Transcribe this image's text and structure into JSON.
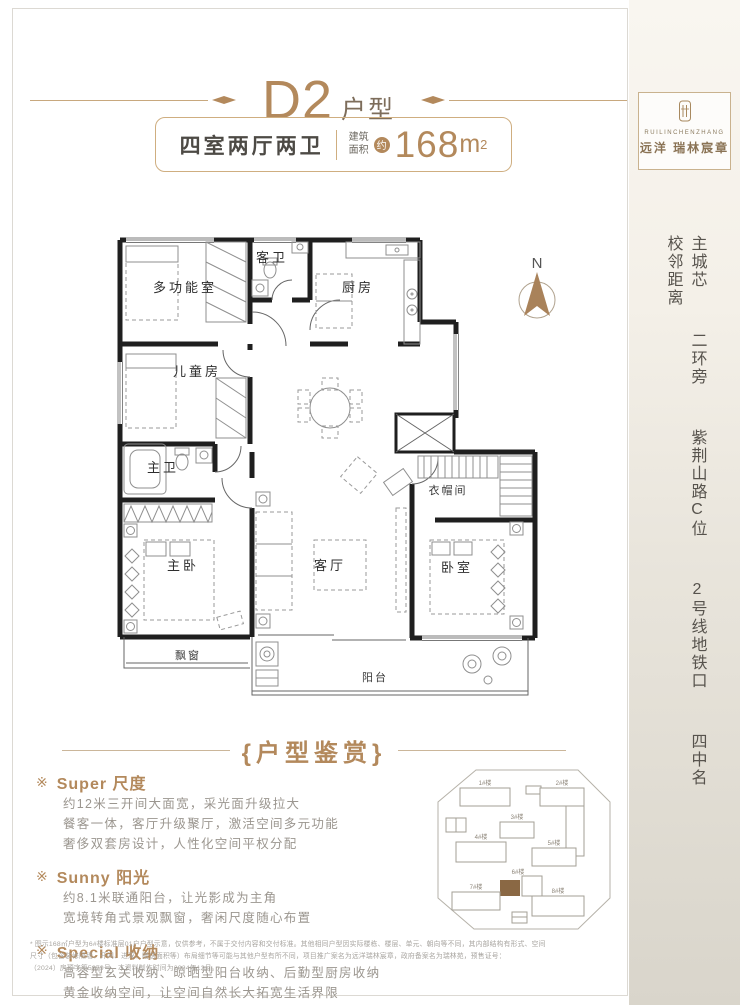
{
  "header": {
    "unit": "D2",
    "unit_suffix": "户型",
    "layout": "四室两厅两卫",
    "area_label_top": "建筑",
    "area_label_bottom": "面积",
    "area_approx": "约",
    "area_value": "168",
    "area_unit": "m",
    "area_sup": "2"
  },
  "brand": {
    "latin": "RUILINCHENZHANG",
    "name": "远洋 瑞林宸章"
  },
  "slogan": {
    "items": [
      "主城芯",
      "二环旁",
      "紫荆山路C位",
      "2号线地铁口",
      "四中名校邻距离"
    ]
  },
  "floorplan": {
    "compass": "N",
    "rooms": {
      "multi_function": "多功能室",
      "guest_bath": "客卫",
      "kitchen": "厨房",
      "kids_room": "儿童房",
      "dining": "餐厅",
      "master_bath": "主卫",
      "master_bedroom": "主卧",
      "bay_window": "飘窗",
      "living": "客厅",
      "balcony": "阳台",
      "bedroom": "卧室",
      "cloakroom": "衣帽间"
    }
  },
  "appreciation": {
    "title": "{户型鉴赏}",
    "items": [
      {
        "marker": "※",
        "title": "Super 尺度",
        "lines": [
          "约12米三开间大面宽，采光面升级拉大",
          "餐客一体，客厅升级聚厅，激活空间多元功能",
          "奢侈双套房设计，人性化空间平权分配"
        ]
      },
      {
        "marker": "※",
        "title": "Sunny 阳光",
        "lines": [
          "约8.1米联通阳台，让光影成为主角",
          "宽境转角式景观飘窗，奢闲尺度随心布置"
        ]
      },
      {
        "marker": "※",
        "title": "Special 收纳",
        "lines": [
          "高容型玄关收纳、晾晒型阳台收纳、后勤型厨房收纳",
          "黄金收纳空间，让空间自然长大拓宽生活界限"
        ]
      }
    ]
  },
  "siteplan": {
    "highlight_color": "#8a6844",
    "buildings": [
      {
        "label": "1#楼"
      },
      {
        "label": "2#楼"
      },
      {
        "label": "3#楼"
      },
      {
        "label": "4#楼"
      },
      {
        "label": "5#楼"
      },
      {
        "label": "6#楼"
      },
      {
        "label": "7#楼"
      },
      {
        "label": "8#楼"
      }
    ]
  },
  "disclaimer": {
    "lines": [
      "* 图示168㎡户型为6#楼标准层01户户型示意，仅供参考，不属于交付内容和交付标准。其他相同户型因实际楼栋、楼层、单元、朝向等不同，其内部结构有形式、空间",
      "尺寸（包含装修隔墙、开间、进深、赠送面积等）布局细节等可能与其他户型有所不同，项目推广案名为远洋瑞林宸章，政府备案名为瑞林苑，预售证号：",
      "（2024）房预字第5879号，本资料制作时间为2024年12月。"
    ]
  }
}
